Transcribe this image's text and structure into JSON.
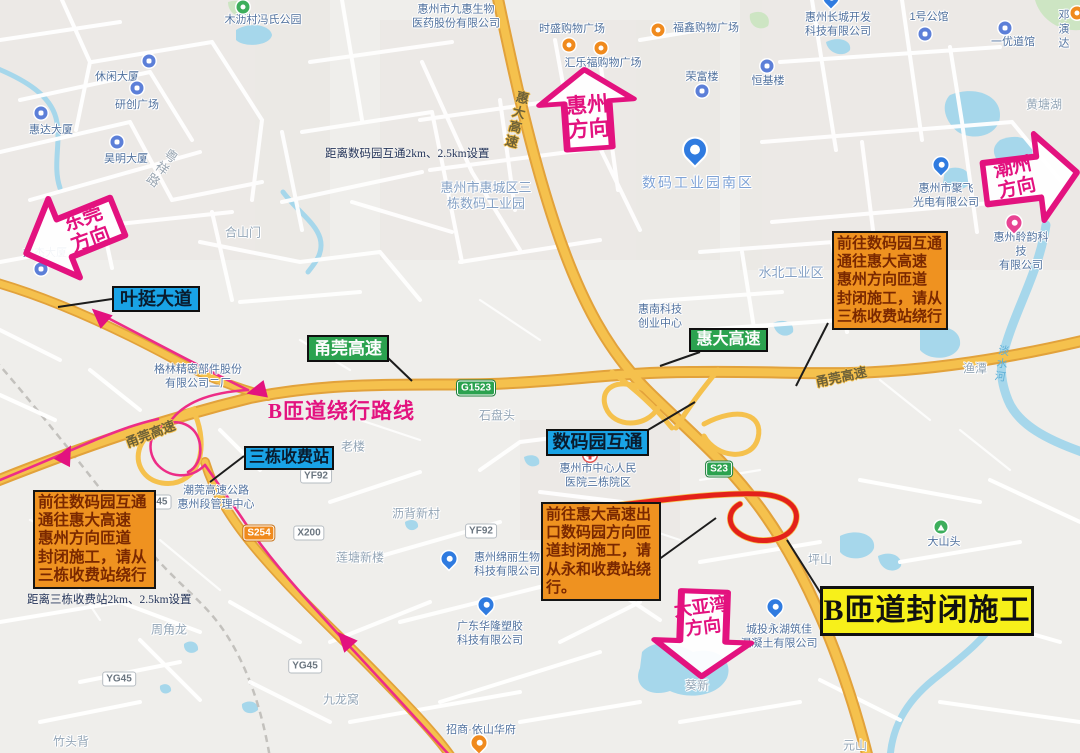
{
  "annotations": {
    "arrows": [
      {
        "id": "dongguan",
        "line1": "东莞",
        "line2": "方向"
      },
      {
        "id": "huizhou",
        "line1": "惠州",
        "line2": "方向"
      },
      {
        "id": "chaozhou",
        "line1": "潮州",
        "line2": "方向"
      },
      {
        "id": "dayawan",
        "line1": "大亚湾",
        "line2": "方向"
      }
    ],
    "notice_boxes": [
      {
        "id": "right",
        "lines": [
          "前往数码园互通",
          "通往惠大高速",
          "惠州方向匝道",
          "封闭施工，请从",
          "三栋收费站绕行"
        ]
      },
      {
        "id": "left",
        "lines": [
          "前往数码园互通",
          "通往惠大高速",
          "惠州方向匝道",
          "封闭施工，请从",
          "三栋收费站绕行"
        ]
      },
      {
        "id": "bottom",
        "lines": [
          "前往惠大高速出",
          "口数码园方向匝",
          "道封闭施工，请",
          "从永和收费站绕",
          "行。"
        ]
      }
    ],
    "closure_label": "B匝道封闭施工",
    "detour_label": "B匝道绕行路线",
    "blue_labels": [
      {
        "text": "叶挺大道"
      },
      {
        "text": "三栋收费站"
      },
      {
        "text": "数码园互通"
      }
    ],
    "green_labels": [
      {
        "text": "甬莞高速"
      },
      {
        "text": "惠大高速"
      }
    ],
    "distance_notes": [
      "距离数码园互通2km、2.5km设置",
      "距离三栋收费站2km、2.5km设置"
    ],
    "colors": {
      "magenta": "#E3127F",
      "orange_box": "#EF9220",
      "orange_box_text": "#7A2800",
      "yellow_label": "#F7F01A",
      "blue_label": "#19A3E6",
      "green_label": "#2BA24F",
      "highway": "#F5C14D",
      "closed_ramp_red": "#E3211A",
      "route_pink": "#ED2D87"
    }
  },
  "map": {
    "pois": [
      {
        "t": "木沥村冯氏公园",
        "x": 263,
        "y": 21,
        "icon": "park",
        "ix": 243,
        "iy": 7
      },
      {
        "t": "休闲大厦",
        "x": 117,
        "y": 78,
        "icon": "bldg",
        "ix": 149,
        "iy": 61
      },
      {
        "t": "研创广场",
        "x": 137,
        "y": 106,
        "icon": "bldg",
        "ix": 137,
        "iy": 88
      },
      {
        "t": "惠达大厦",
        "x": 51,
        "y": 131,
        "icon": "bldg",
        "ix": 41,
        "iy": 113
      },
      {
        "t": "昊明大厦",
        "x": 126,
        "y": 160,
        "icon": "bldg",
        "ix": 117,
        "iy": 142
      },
      {
        "t": "龙杰大厦",
        "x": 45,
        "y": 254,
        "icon": "bldg",
        "ix": 41,
        "iy": 269
      },
      {
        "t": "惠州市九惠生物\n医药股份有限公司",
        "x": 456,
        "y": 17
      },
      {
        "t": "时盛购物广场",
        "x": 572,
        "y": 30,
        "icon": "shop",
        "ix": 569,
        "iy": 45
      },
      {
        "t": "汇乐福购物广场",
        "x": 603,
        "y": 64,
        "icon": "shop",
        "ix": 601,
        "iy": 48
      },
      {
        "t": "福鑫购物广场",
        "x": 706,
        "y": 29,
        "icon": "shop",
        "ix": 658,
        "iy": 30
      },
      {
        "t": "荣富楼",
        "x": 702,
        "y": 78,
        "icon": "bldg",
        "ix": 702,
        "iy": 91
      },
      {
        "t": "恒基楼",
        "x": 768,
        "y": 82,
        "icon": "bldg",
        "ix": 767,
        "iy": 66
      },
      {
        "t": "惠州长城开发\n科技有限公司",
        "x": 838,
        "y": 25,
        "icon": "pinb",
        "ix": 831,
        "iy": 3
      },
      {
        "t": "1号公馆",
        "x": 929,
        "y": 18,
        "icon": "bldg",
        "ix": 925,
        "iy": 34
      },
      {
        "t": "一优道馆",
        "x": 1013,
        "y": 43,
        "icon": "bldg",
        "ix": 1005,
        "iy": 28
      },
      {
        "t": "邓演达",
        "x": 1064,
        "y": 30,
        "icon": "shop",
        "ix": 1077,
        "iy": 13
      },
      {
        "t": "惠州市聚飞\n光电有限公司",
        "x": 946,
        "y": 196,
        "icon": "pinb",
        "ix": 941,
        "iy": 170
      },
      {
        "t": "惠州聆韵科技\n有限公司",
        "x": 1021,
        "y": 252,
        "icon": "pinp",
        "ix": 1014,
        "iy": 228
      },
      {
        "t": "惠州市中心人民\n医院三栋院区",
        "x": 598,
        "y": 476,
        "icon": "hosp",
        "ix": 590,
        "iy": 455
      },
      {
        "t": "格林精密部件股份\n有限公司二厂",
        "x": 198,
        "y": 377
      },
      {
        "t": "潮莞高速公路\n惠州段管理中心",
        "x": 216,
        "y": 498
      },
      {
        "t": "惠南科技\n创业中心",
        "x": 660,
        "y": 317
      },
      {
        "t": "惠州绵丽生物\n科技有限公司",
        "x": 507,
        "y": 565,
        "icon": "pinb",
        "ix": 449,
        "iy": 564
      },
      {
        "t": "广东华隆塑胶\n科技有限公司",
        "x": 490,
        "y": 634,
        "icon": "pinb",
        "ix": 486,
        "iy": 610
      },
      {
        "t": "招商·依山华府",
        "x": 481,
        "y": 731,
        "icon": "pino",
        "ix": 479,
        "iy": 748
      },
      {
        "t": "城投永湖筑佳\n混凝土有限公司",
        "x": 779,
        "y": 637,
        "icon": "pinb",
        "ix": 775,
        "iy": 612
      },
      {
        "t": "大山头",
        "x": 944,
        "y": 543,
        "icon": "mtn",
        "ix": 941,
        "iy": 527
      }
    ],
    "places": [
      {
        "t": "黄塘湖",
        "x": 1044,
        "y": 105
      },
      {
        "t": "水北工业区",
        "x": 791,
        "y": 273,
        "cls": "lg"
      },
      {
        "t": "惠州市惠城区三\n栋数码工业园",
        "x": 486,
        "y": 196,
        "cls": "lg"
      },
      {
        "t": "数码工业园南区",
        "x": 698,
        "y": 183,
        "cls": "xl"
      },
      {
        "t": "合山门",
        "x": 243,
        "y": 233
      },
      {
        "t": "石盘头",
        "x": 497,
        "y": 416
      },
      {
        "t": "老楼",
        "x": 353,
        "y": 447
      },
      {
        "t": "渔潭",
        "x": 975,
        "y": 369
      },
      {
        "t": "坪山",
        "x": 820,
        "y": 560
      },
      {
        "t": "周角龙",
        "x": 169,
        "y": 630
      },
      {
        "t": "九龙窝",
        "x": 341,
        "y": 700
      },
      {
        "t": "竹头背",
        "x": 71,
        "y": 742
      },
      {
        "t": "沥背新村",
        "x": 416,
        "y": 514
      },
      {
        "t": "莲塘新楼",
        "x": 360,
        "y": 558
      },
      {
        "t": "葵新",
        "x": 697,
        "y": 686
      },
      {
        "t": "元山",
        "x": 855,
        "y": 746
      }
    ],
    "standalone_icons": [
      {
        "icon": "pinbig",
        "ix": 695,
        "iy": 158,
        "name": "digital-park-south-pin"
      }
    ],
    "shields": [
      {
        "t": "G1523",
        "c": "green",
        "x": 476,
        "y": 388
      },
      {
        "t": "S23",
        "c": "green",
        "x": 719,
        "y": 469
      },
      {
        "t": "S254",
        "c": "orange",
        "x": 259,
        "y": 533
      },
      {
        "t": "X200",
        "c": "white",
        "x": 309,
        "y": 533
      },
      {
        "t": "YF92",
        "c": "white",
        "x": 316,
        "y": 476
      },
      {
        "t": "YF92",
        "c": "white",
        "x": 481,
        "y": 531
      },
      {
        "t": "YG45",
        "c": "white",
        "x": 119,
        "y": 679
      },
      {
        "t": "YG45",
        "c": "white",
        "x": 305,
        "y": 666
      },
      {
        "t": "G45",
        "c": "white",
        "x": 158,
        "y": 502
      }
    ],
    "roadnames": [
      {
        "t": "惠大高速",
        "x": 516,
        "y": 120,
        "rot": 14,
        "v": 1,
        "cls": ""
      },
      {
        "t": "甬莞高速",
        "x": 150,
        "y": 433,
        "rot": -21,
        "cls": ""
      },
      {
        "t": "甬莞高速",
        "x": 841,
        "y": 376,
        "rot": -12,
        "cls": ""
      },
      {
        "t": "粤祥路",
        "x": 161,
        "y": 168,
        "rot": 36,
        "v": 1,
        "cls": "gray"
      },
      {
        "t": "淡水河",
        "x": 1001,
        "y": 364,
        "rot": 8,
        "v": 1,
        "cls": "water"
      }
    ]
  }
}
